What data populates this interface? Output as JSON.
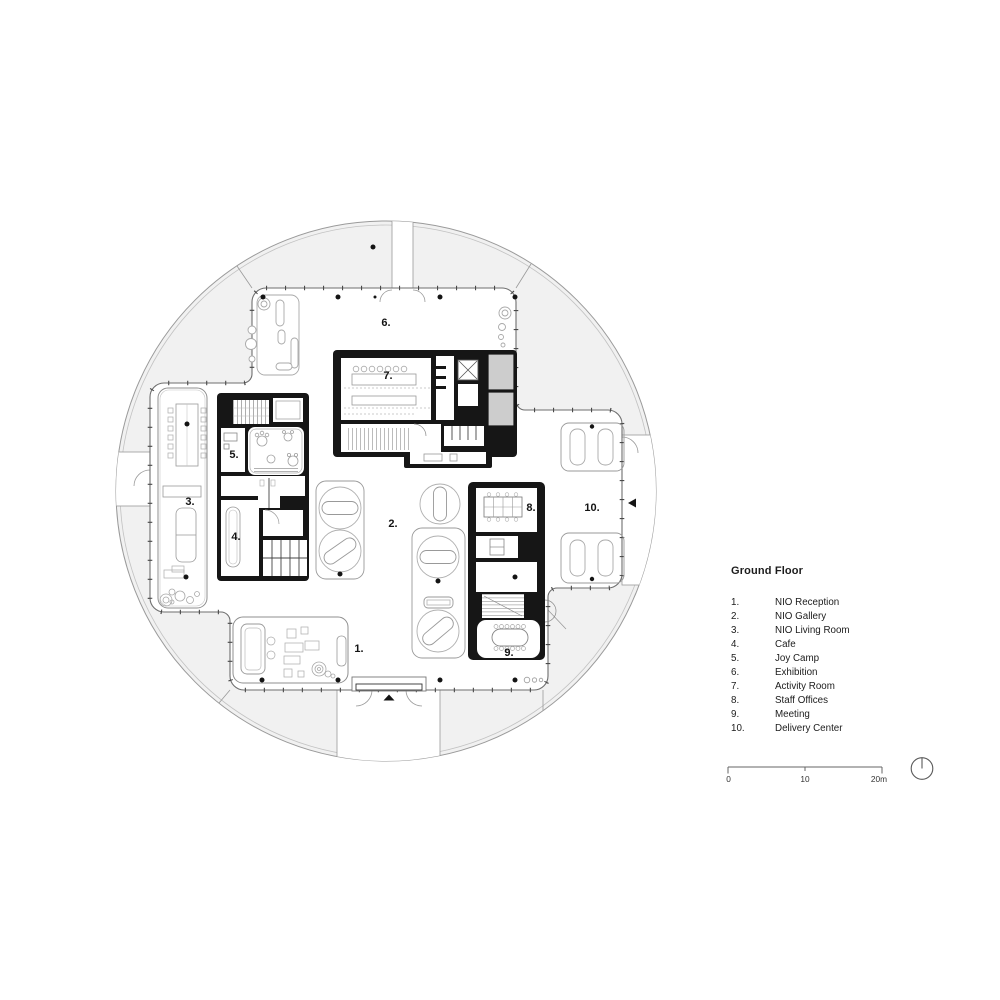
{
  "plan": {
    "room_labels": [
      {
        "text": "1."
      },
      {
        "text": "2."
      },
      {
        "text": "3."
      },
      {
        "text": "4."
      },
      {
        "text": "5."
      },
      {
        "text": "6."
      },
      {
        "text": "7."
      },
      {
        "text": "8."
      },
      {
        "text": "9."
      },
      {
        "text": "10."
      }
    ]
  },
  "legend": {
    "title": "Ground Floor",
    "items": [
      {
        "num": "1.",
        "name": "NIO Reception"
      },
      {
        "num": "2.",
        "name": "NIO Gallery"
      },
      {
        "num": "3.",
        "name": "NIO Living Room"
      },
      {
        "num": "4.",
        "name": "Cafe"
      },
      {
        "num": "5.",
        "name": "Joy Camp"
      },
      {
        "num": "6.",
        "name": "Exhibition"
      },
      {
        "num": "7.",
        "name": "Activity Room"
      },
      {
        "num": "8.",
        "name": "Staff Offices"
      },
      {
        "num": "9.",
        "name": "Meeting"
      },
      {
        "num": "10.",
        "name": "Delivery Center"
      }
    ]
  },
  "scalebar": {
    "t0": "0",
    "t10": "10",
    "t20": "20m"
  },
  "colors": {
    "wall_black": "#161616",
    "band_gray": "#f1f1f1",
    "room_gray": "#cdcdcd",
    "line_gray": "#8a8a8a"
  }
}
